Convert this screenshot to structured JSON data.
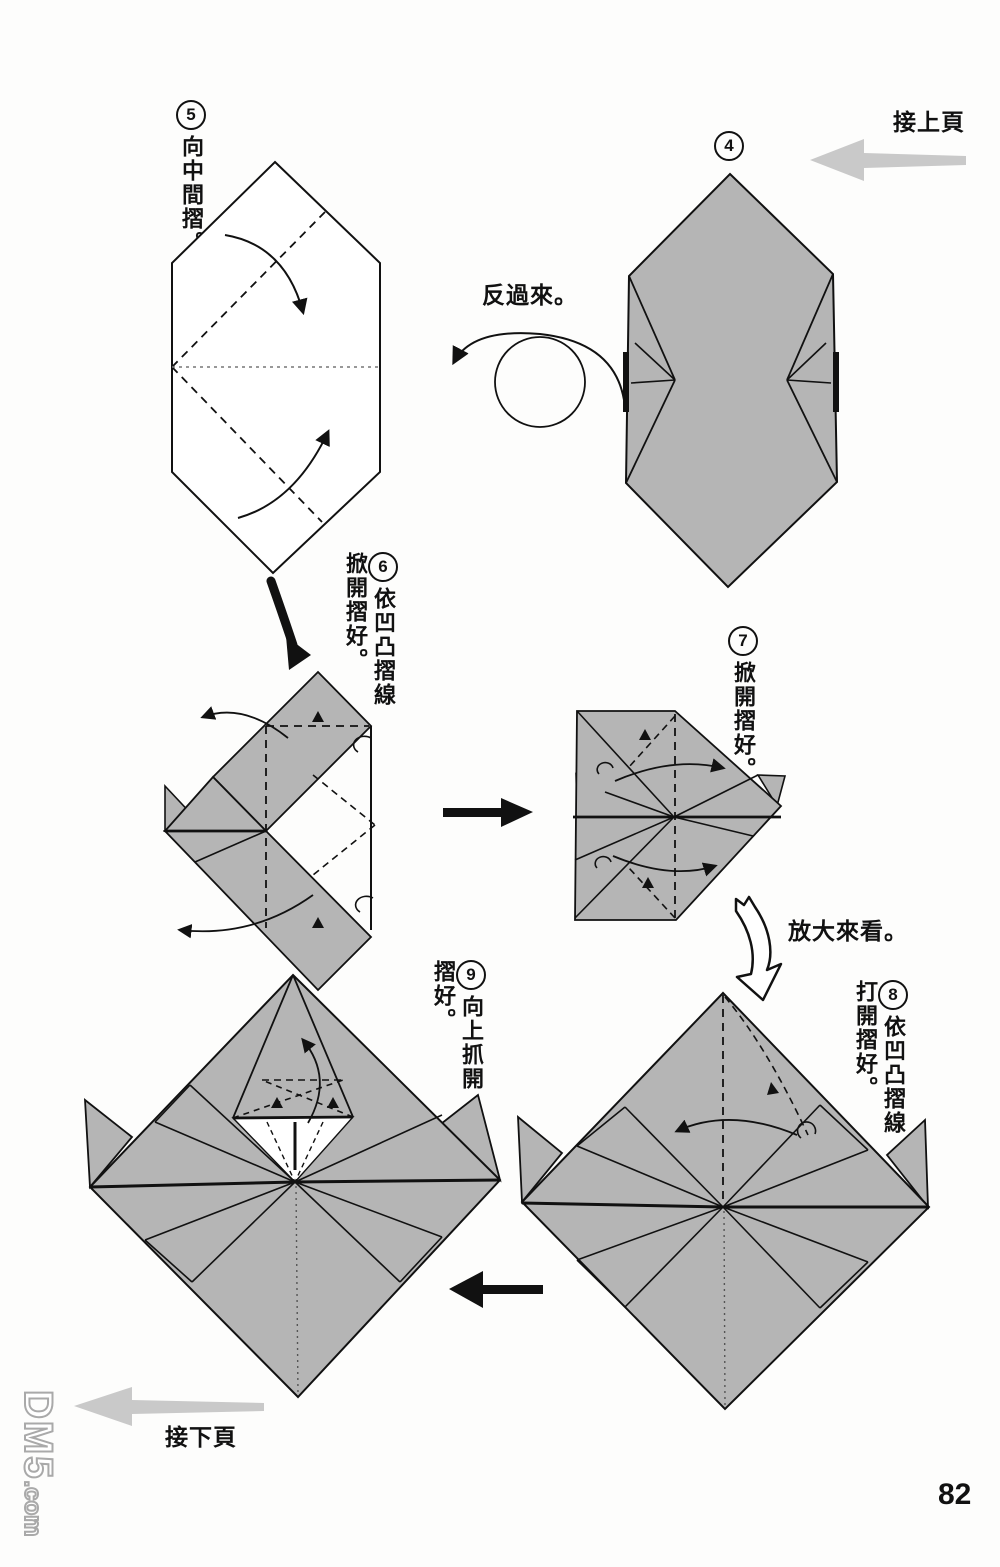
{
  "page": {
    "number": "82",
    "watermark": {
      "main": "DM5",
      "sub": ".com"
    }
  },
  "nav": {
    "prev_label": "接上頁",
    "next_label": "接下頁"
  },
  "notes": {
    "turn_over": "反過來。",
    "enlarge": "放大來看。"
  },
  "steps": [
    {
      "num": "4",
      "text": ""
    },
    {
      "num": "5",
      "text": "向中間摺。"
    },
    {
      "num": "6",
      "text": "依凹凸摺線掀開摺好。"
    },
    {
      "num": "7",
      "text": "掀開摺好。"
    },
    {
      "num": "8",
      "text": "依凹凸摺線打開摺好。"
    },
    {
      "num": "9",
      "text": "向上抓開摺好。"
    }
  ],
  "colors": {
    "paper_gray": "#b5b5b5",
    "nav_arrow_gray": "#c9c9c9",
    "ink": "#111111"
  }
}
